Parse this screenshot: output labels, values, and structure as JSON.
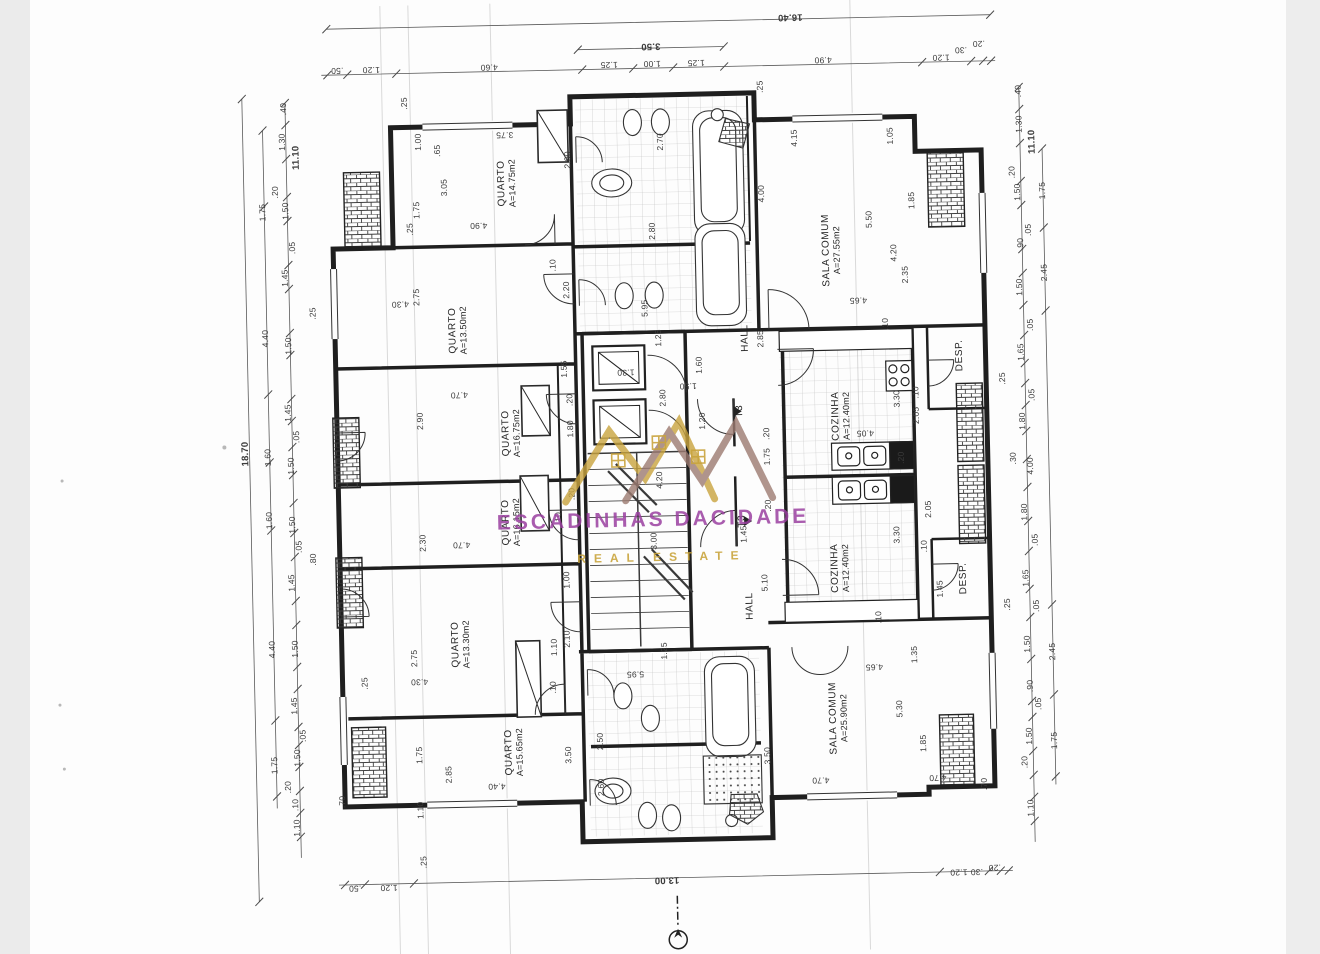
{
  "document": {
    "type": "scanned architectural floor plan",
    "plan_type_label": "T3",
    "scale_note": ""
  },
  "watermark": {
    "line1": "ESCADINHAS DACIDADE",
    "line2": "REAL ESTATE",
    "color_primary": "#9a3fa0",
    "color_gold": "#c9a43e",
    "color_secondary": "#9c7a70"
  },
  "plan": {
    "rooms": [
      {
        "name": "QUARTO",
        "area": "A=14.75m2",
        "x": 513,
        "y": 180,
        "r": -90
      },
      {
        "name": "QUARTO",
        "area": "A=13.50m2",
        "x": 461,
        "y": 326,
        "r": -90
      },
      {
        "name": "QUARTO",
        "area": "A=16.75m2",
        "x": 512,
        "y": 430,
        "r": -90
      },
      {
        "name": "QUARTO",
        "area": "A=16.15m2",
        "x": 510,
        "y": 519,
        "r": -90
      },
      {
        "name": "QUARTO",
        "area": "A=13.30m2",
        "x": 457,
        "y": 640,
        "r": -90
      },
      {
        "name": "QUARTO",
        "area": "A=15.65m2",
        "x": 508,
        "y": 749,
        "r": -90
      },
      {
        "name": "SALA COMUM",
        "area": "A=27.55m2",
        "x": 836,
        "y": 254,
        "r": -90
      },
      {
        "name": "SALA COMUM",
        "area": "A=25.90m2",
        "x": 833,
        "y": 722,
        "r": -90
      },
      {
        "name": "COZINHA",
        "area": "A=12.40m2",
        "x": 842,
        "y": 420,
        "r": -90
      },
      {
        "name": "COZINHA",
        "area": "A=12.40m2",
        "x": 838,
        "y": 572,
        "r": -90
      },
      {
        "name": "DESP.",
        "area": "",
        "x": 962,
        "y": 362,
        "r": -90
      },
      {
        "name": "DESP.",
        "area": "",
        "x": 961,
        "y": 585,
        "r": -90
      },
      {
        "name": "HALL",
        "area": "",
        "x": 748,
        "y": 340,
        "r": -90
      },
      {
        "name": "HALL",
        "area": "",
        "x": 747,
        "y": 608,
        "r": -90
      },
      {
        "name": "T3",
        "area": "",
        "x": 741,
        "y": 413,
        "r": -90
      },
      {
        "name": "T3",
        "area": "",
        "x": 741,
        "y": 523,
        "r": -90
      }
    ],
    "dimensions": [
      {
        "t": "16.40",
        "x": 800,
        "y": 20,
        "r": 180,
        "big": true
      },
      {
        "t": "3.50",
        "x": 660,
        "y": 46,
        "r": 180,
        "big": true
      },
      {
        "t": ".50",
        "x": 346,
        "y": 64,
        "r": 180
      },
      {
        "t": "1.20",
        "x": 380,
        "y": 64,
        "r": 180
      },
      {
        "t": "4.60",
        "x": 498,
        "y": 64,
        "r": 180
      },
      {
        "t": "1.25",
        "x": 618,
        "y": 64,
        "r": 180
      },
      {
        "t": "1.00",
        "x": 661,
        "y": 64,
        "r": 180
      },
      {
        "t": "1.25",
        "x": 705,
        "y": 64,
        "r": 180
      },
      {
        "t": "4.90",
        "x": 832,
        "y": 64,
        "r": 180
      },
      {
        "t": "1.20",
        "x": 950,
        "y": 64,
        "r": 180
      },
      {
        "t": ".30",
        "x": 970,
        "y": 57,
        "r": 180
      },
      {
        "t": ".20",
        "x": 988,
        "y": 51,
        "r": 180
      },
      {
        "t": ".50",
        "x": 346,
        "y": 882,
        "r": 180
      },
      {
        "t": "1.20",
        "x": 380,
        "y": 882,
        "r": 180
      },
      {
        "t": "13.00",
        "x": 658,
        "y": 880,
        "r": 180,
        "big": true
      },
      {
        "t": "1.20",
        "x": 950,
        "y": 879,
        "r": 180
      },
      {
        "t": ".30",
        "x": 968,
        "y": 879,
        "r": 180
      },
      {
        "t": ".20",
        "x": 986,
        "y": 875,
        "r": 180
      },
      {
        "t": ".25",
        "x": 415,
        "y": 857
      },
      {
        "t": "18.70",
        "x": 246,
        "y": 445,
        "big": true
      },
      {
        "t": "11.10",
        "x": 303,
        "y": 150,
        "big": true
      },
      {
        "t": ".40",
        "x": 291,
        "y": 101
      },
      {
        "t": "1.30",
        "x": 289,
        "y": 134
      },
      {
        "t": ".20",
        "x": 281,
        "y": 184
      },
      {
        "t": "1.50",
        "x": 291,
        "y": 203
      },
      {
        "t": "1.75",
        "x": 268,
        "y": 204
      },
      {
        "t": ".05",
        "x": 297,
        "y": 240
      },
      {
        "t": "1.45",
        "x": 289,
        "y": 270
      },
      {
        "t": "4.40",
        "x": 268,
        "y": 330
      },
      {
        "t": "1.50",
        "x": 291,
        "y": 338
      },
      {
        "t": "1.45",
        "x": 289,
        "y": 405
      },
      {
        "t": ".05",
        "x": 297,
        "y": 429
      },
      {
        "t": "1.60",
        "x": 268,
        "y": 449
      },
      {
        "t": "1.50",
        "x": 291,
        "y": 458
      },
      {
        "t": "1.60",
        "x": 268,
        "y": 512
      },
      {
        "t": "1.50",
        "x": 291,
        "y": 517
      },
      {
        "t": ".05",
        "x": 297,
        "y": 539
      },
      {
        "t": "1.45",
        "x": 289,
        "y": 575
      },
      {
        "t": "4.40",
        "x": 268,
        "y": 641
      },
      {
        "t": "1.50",
        "x": 291,
        "y": 641
      },
      {
        "t": "1.45",
        "x": 289,
        "y": 698
      },
      {
        "t": ".05",
        "x": 297,
        "y": 728
      },
      {
        "t": "1.50",
        "x": 291,
        "y": 750
      },
      {
        "t": "1.75",
        "x": 268,
        "y": 757
      },
      {
        "t": ".20",
        "x": 281,
        "y": 779
      },
      {
        "t": ".10",
        "x": 288,
        "y": 797
      },
      {
        "t": "1.10",
        "x": 289,
        "y": 820
      },
      {
        "t": ".80",
        "x": 311,
        "y": 552
      },
      {
        "t": ".70",
        "x": 335,
        "y": 795
      },
      {
        "t": ".25",
        "x": 316,
        "y": 306
      },
      {
        "t": ".25",
        "x": 360,
        "y": 677
      },
      {
        "t": "11.10",
        "x": 1039,
        "y": 150,
        "big": true
      },
      {
        "t": ".40",
        "x": 1026,
        "y": 99
      },
      {
        "t": "1.30",
        "x": 1026,
        "y": 132
      },
      {
        "t": ".20",
        "x": 1018,
        "y": 180
      },
      {
        "t": "1.50",
        "x": 1023,
        "y": 200
      },
      {
        "t": "1.75",
        "x": 1048,
        "y": 199
      },
      {
        "t": ".05",
        "x": 1033,
        "y": 238
      },
      {
        "t": ".90",
        "x": 1025,
        "y": 252
      },
      {
        "t": "2.45",
        "x": 1048,
        "y": 281
      },
      {
        "t": "1.50",
        "x": 1023,
        "y": 295
      },
      {
        "t": ".05",
        "x": 1033,
        "y": 333
      },
      {
        "t": "1.65",
        "x": 1023,
        "y": 360
      },
      {
        "t": ".25",
        "x": 1004,
        "y": 386
      },
      {
        "t": ".05",
        "x": 1033,
        "y": 403
      },
      {
        "t": "1.80",
        "x": 1023,
        "y": 429
      },
      {
        "t": ".30",
        "x": 1013,
        "y": 466
      },
      {
        "t": "4.00",
        "x": 1030,
        "y": 474
      },
      {
        "t": "1.80",
        "x": 1023,
        "y": 520
      },
      {
        "t": ".05",
        "x": 1033,
        "y": 548
      },
      {
        "t": "1.65",
        "x": 1023,
        "y": 586
      },
      {
        "t": ".25",
        "x": 1004,
        "y": 612
      },
      {
        "t": ".05",
        "x": 1033,
        "y": 614
      },
      {
        "t": "1.50",
        "x": 1023,
        "y": 652
      },
      {
        "t": "2.45",
        "x": 1048,
        "y": 660
      },
      {
        "t": ".90",
        "x": 1025,
        "y": 694
      },
      {
        "t": ".05",
        "x": 1033,
        "y": 712
      },
      {
        "t": "1.50",
        "x": 1023,
        "y": 744
      },
      {
        "t": "1.75",
        "x": 1048,
        "y": 749
      },
      {
        "t": ".20",
        "x": 1018,
        "y": 770
      },
      {
        "t": "1.10",
        "x": 1023,
        "y": 816
      },
      {
        "t": ".70",
        "x": 977,
        "y": 791
      },
      {
        "t": ".25",
        "x": 412,
        "y": 98
      },
      {
        "t": "1.00",
        "x": 425,
        "y": 137
      },
      {
        "t": ".65",
        "x": 444,
        "y": 146
      },
      {
        "t": "3.75",
        "x": 512,
        "y": 132,
        "r": 180
      },
      {
        "t": "3.05",
        "x": 450,
        "y": 183
      },
      {
        "t": "1.75",
        "x": 422,
        "y": 205
      },
      {
        "t": ".25",
        "x": 415,
        "y": 224
      },
      {
        "t": "2.00",
        "x": 574,
        "y": 158
      },
      {
        "t": "2.70",
        "x": 667,
        "y": 142
      },
      {
        "t": "2.80",
        "x": 657,
        "y": 231
      },
      {
        "t": ".25",
        "x": 768,
        "y": 89
      },
      {
        "t": "4.00",
        "x": 767,
        "y": 196
      },
      {
        "t": "4.15",
        "x": 801,
        "y": 141
      },
      {
        "t": "1.05",
        "x": 897,
        "y": 141
      },
      {
        "t": "1.85",
        "x": 917,
        "y": 206
      },
      {
        "t": "5.50",
        "x": 874,
        "y": 224
      },
      {
        "t": "4.20",
        "x": 898,
        "y": 258
      },
      {
        "t": "2.35",
        "x": 909,
        "y": 280
      },
      {
        "t": "4.65",
        "x": 862,
        "y": 305,
        "r": 180
      },
      {
        "t": ".10",
        "x": 888,
        "y": 329
      },
      {
        "t": "4.90",
        "x": 484,
        "y": 222,
        "r": 180
      },
      {
        "t": "2.20",
        "x": 570,
        "y": 288
      },
      {
        "t": "5.95",
        "x": 648,
        "y": 308
      },
      {
        "t": "1.25",
        "x": 661,
        "y": 338
      },
      {
        "t": "2.75",
        "x": 420,
        "y": 292
      },
      {
        "t": "4.30",
        "x": 404,
        "y": 299,
        "r": 180
      },
      {
        "t": "2.90",
        "x": 421,
        "y": 416
      },
      {
        "t": "4.70",
        "x": 461,
        "y": 391,
        "r": 180
      },
      {
        "t": "1.80",
        "x": 571,
        "y": 427
      },
      {
        "t": ".20",
        "x": 571,
        "y": 398
      },
      {
        "t": "2.30",
        "x": 421,
        "y": 538
      },
      {
        "t": "4.70",
        "x": 460,
        "y": 541,
        "r": 180
      },
      {
        "t": ".20",
        "x": 571,
        "y": 492
      },
      {
        "t": "1.00",
        "x": 564,
        "y": 578
      },
      {
        "t": "1.55",
        "x": 566,
        "y": 367
      },
      {
        "t": "1.30",
        "x": 628,
        "y": 372,
        "r": 180
      },
      {
        "t": "2.80",
        "x": 664,
        "y": 398
      },
      {
        "t": "1.50",
        "x": 690,
        "y": 387,
        "r": 180
      },
      {
        "t": "1.60",
        "x": 701,
        "y": 366
      },
      {
        "t": "1.20",
        "x": 703,
        "y": 422
      },
      {
        "t": "2.75",
        "x": 410,
        "y": 653
      },
      {
        "t": "4.30",
        "x": 415,
        "y": 677,
        "r": 180
      },
      {
        "t": "1.10",
        "x": 550,
        "y": 645
      },
      {
        "t": "2.10",
        "x": 563,
        "y": 637
      },
      {
        "t": ".10",
        "x": 548,
        "y": 685
      },
      {
        "t": "1.25",
        "x": 660,
        "y": 651
      },
      {
        "t": "5.95",
        "x": 631,
        "y": 674,
        "r": 180
      },
      {
        "t": "3.00",
        "x": 652,
        "y": 541
      },
      {
        "t": "4.20",
        "x": 659,
        "y": 480
      },
      {
        "t": "1.45",
        "x": 742,
        "y": 536
      },
      {
        "t": "5.10",
        "x": 762,
        "y": 585
      },
      {
        "t": "2.85",
        "x": 763,
        "y": 341
      },
      {
        "t": "1.75",
        "x": 767,
        "y": 459
      },
      {
        "t": ".20",
        "x": 767,
        "y": 436
      },
      {
        "t": ".20",
        "x": 767,
        "y": 508
      },
      {
        "t": "3.30",
        "x": 898,
        "y": 404
      },
      {
        "t": "2.05",
        "x": 917,
        "y": 421
      },
      {
        "t": ".10",
        "x": 917,
        "y": 398
      },
      {
        "t": "4.05",
        "x": 866,
        "y": 438,
        "r": 180
      },
      {
        "t": ".20",
        "x": 901,
        "y": 463
      },
      {
        "t": "2.05",
        "x": 927,
        "y": 515
      },
      {
        "t": "3.30",
        "x": 895,
        "y": 540
      },
      {
        "t": ".10",
        "x": 922,
        "y": 552
      },
      {
        "t": "1.45",
        "x": 937,
        "y": 595
      },
      {
        "t": "1.35",
        "x": 910,
        "y": 660
      },
      {
        "t": ".10",
        "x": 875,
        "y": 622
      },
      {
        "t": "4.65",
        "x": 870,
        "y": 672,
        "r": 180
      },
      {
        "t": "5.30",
        "x": 894,
        "y": 714
      },
      {
        "t": "1.85",
        "x": 917,
        "y": 749
      },
      {
        "t": "4.70",
        "x": 931,
        "y": 784,
        "r": 180
      },
      {
        "t": "3.50",
        "x": 562,
        "y": 753
      },
      {
        "t": "3.50",
        "x": 761,
        "y": 758
      },
      {
        "t": "2.50",
        "x": 594,
        "y": 740
      },
      {
        "t": "2.60",
        "x": 594,
        "y": 786
      },
      {
        "t": "2.85",
        "x": 442,
        "y": 770
      },
      {
        "t": "1.75",
        "x": 413,
        "y": 750
      },
      {
        "t": "1.10",
        "x": 413,
        "y": 805
      },
      {
        "t": "4.40",
        "x": 490,
        "y": 783,
        "r": 180
      },
      {
        "t": "4.70",
        "x": 814,
        "y": 784,
        "r": 180
      },
      {
        "t": ".10",
        "x": 557,
        "y": 263
      },
      {
        "t": ".10",
        "x": 557,
        "y": 516
      }
    ]
  }
}
